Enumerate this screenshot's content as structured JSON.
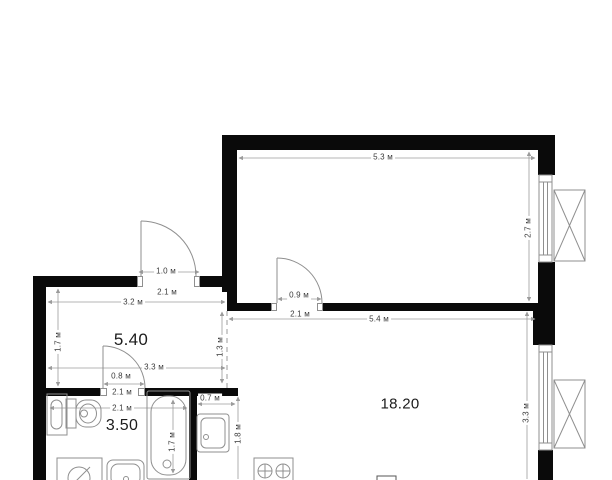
{
  "plan": {
    "room_labels": [
      {
        "id": "hallway",
        "text": "5.40"
      },
      {
        "id": "bathroom",
        "text": "3.50"
      },
      {
        "id": "living-room",
        "text": "18.20"
      }
    ],
    "dim_labels": [
      {
        "text": "5.3 м"
      },
      {
        "text": "2.7 м"
      },
      {
        "text": "1.0 м"
      },
      {
        "text": "2.1 м"
      },
      {
        "text": "3.2 м"
      },
      {
        "text": "0.9 м"
      },
      {
        "text": "2.1 м"
      },
      {
        "text": "5.4 м"
      },
      {
        "text": "1.7 м"
      },
      {
        "text": "1.3 м"
      },
      {
        "text": "3.3 м"
      },
      {
        "text": "0.8 м"
      },
      {
        "text": "2.1 м"
      },
      {
        "text": "2.1 м"
      },
      {
        "text": "0.7 м"
      },
      {
        "text": "1.7 м"
      },
      {
        "text": "1.8 м"
      },
      {
        "text": "3.3 м"
      }
    ],
    "icons": [
      "entrance-door-icon",
      "room-door-icon",
      "bathroom-door-icon",
      "window-icon",
      "radiator-icon",
      "toilet-icon",
      "washbasin-cabinet-icon",
      "washbasin-icon",
      "bathtub-icon",
      "washing-machine-icon",
      "kitchen-sink-icon",
      "stove-icon"
    ],
    "colors": {
      "wall": "#0a0a0a",
      "fixture_line": "#8f8f8f",
      "dimension_line": "#9b9b9b",
      "text": "#1c1c1c",
      "background": "#ffffff"
    }
  }
}
